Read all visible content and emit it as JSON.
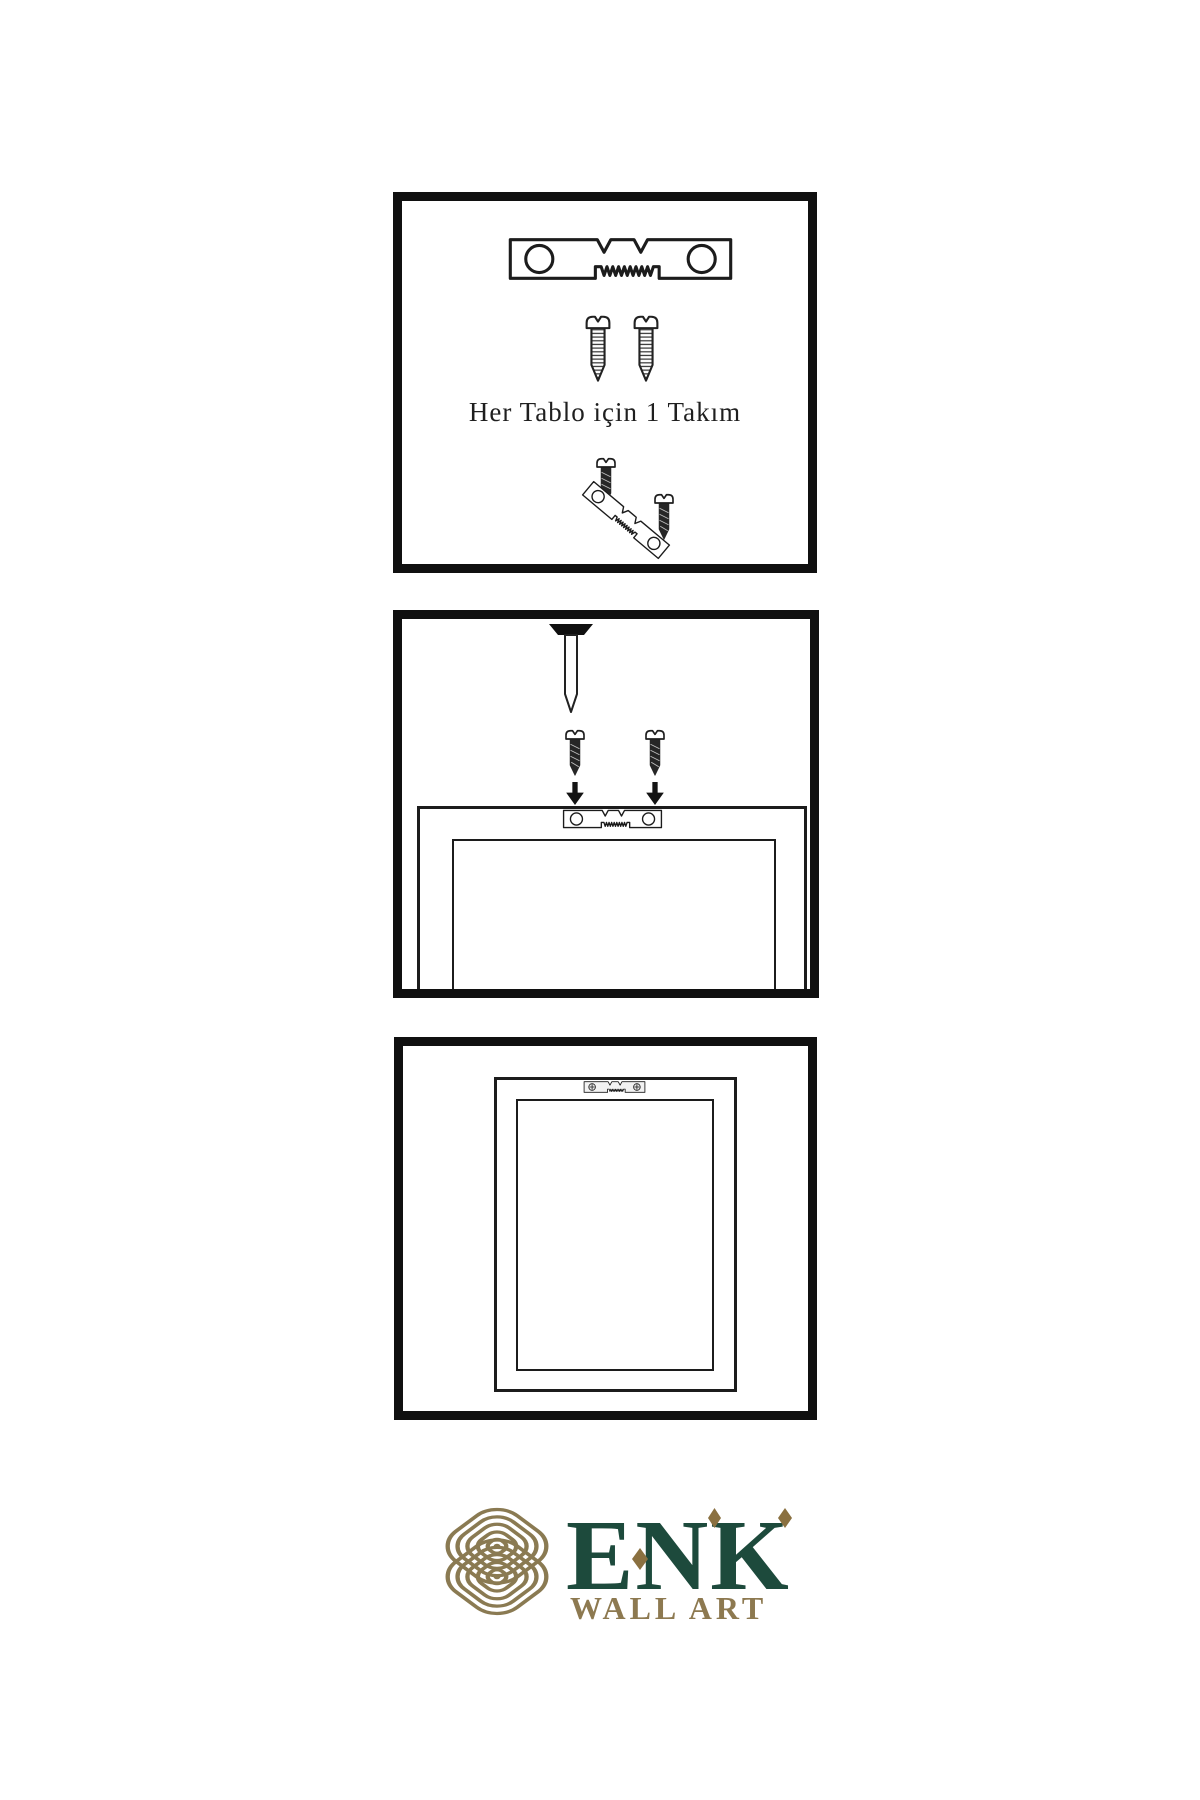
{
  "document": {
    "type": "wall-art installation instruction sheet",
    "background": "#ffffff"
  },
  "panel_kit": {
    "caption": "Her Tablo için 1 Takım",
    "icons": [
      "sawtooth-hanger-icon",
      "screw-icon",
      "screw-icon",
      "hanger-with-screws-icon"
    ]
  },
  "panel_install": {
    "icons": [
      "nail-icon",
      "dark-screw-icon",
      "dark-screw-icon",
      "arrow-down-icon",
      "arrow-down-icon",
      "sawtooth-hanger-icon",
      "frame-back-outline"
    ]
  },
  "panel_hung": {
    "icons": [
      "sawtooth-hanger-mounted-icon",
      "frame-back-outline"
    ]
  },
  "logo": {
    "brand": "ENK",
    "subtitle": "WALL ART",
    "icon": "knot-logo-icon",
    "colors": {
      "brand_green": "#1d4a3c",
      "brand_gold": "#8d7950",
      "knot_gold": "#8a7a52",
      "diamond_gold": "#8a7040"
    }
  },
  "colors": {
    "line_art": "#1c1c1c",
    "panel_border": "#101010",
    "screw_dark_fill": "#262626"
  }
}
